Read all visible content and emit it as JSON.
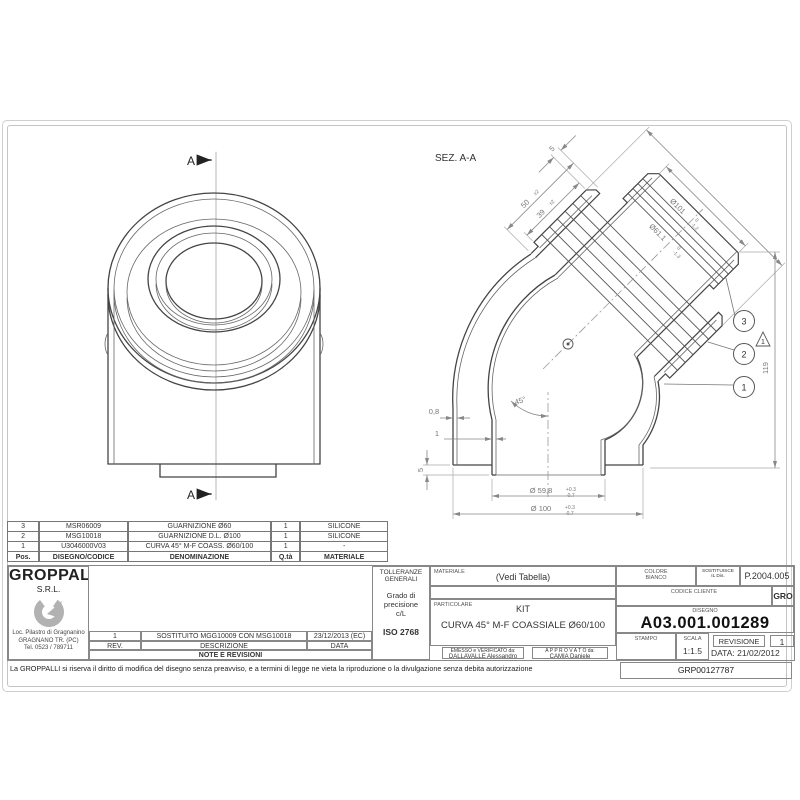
{
  "views": {
    "front": {
      "section_label_top": "A",
      "section_label_bottom": "A"
    },
    "section": {
      "title": "SEZ. A-A",
      "dims": {
        "len50": {
          "v": "50",
          "tol": "±2"
        },
        "len39": {
          "v": "39",
          "tol": "±2"
        },
        "len5_top": "5",
        "dia101": {
          "v": "Ø101",
          "tol_hi": "0",
          "tol_lo": "-1.2"
        },
        "dia61": {
          "v": "Ø61.1",
          "tol_hi": "0",
          "tol_lo": "-1.3"
        },
        "height119": "119",
        "angle": "45°",
        "wall08": "0,8",
        "wall1": "1",
        "step5": "5",
        "dia598": {
          "v": "Ø 59,8",
          "tol_hi": "+0.3",
          "tol_lo": "-0.7"
        },
        "dia100": {
          "v": "Ø 100",
          "tol_hi": "+0.3",
          "tol_lo": "-0.7"
        }
      },
      "balloons": {
        "b1": "1",
        "b2": "2",
        "b3": "3"
      },
      "rev_flag": "1"
    }
  },
  "parts_table": {
    "headers": [
      "Pos.",
      "DISEGNO/CODICE",
      "DENOMINAZIONE",
      "Q.tà",
      "MATERIALE"
    ],
    "rows": [
      {
        "pos": "3",
        "code": "MSR06009",
        "name": "GUARNIZIONE Ø60",
        "qty": "1",
        "material": "SILICONE"
      },
      {
        "pos": "2",
        "code": "MSG10018",
        "name": "GUARNIZIONE D.L. Ø100",
        "qty": "1",
        "material": "SILICONE"
      },
      {
        "pos": "1",
        "code": "U3046000V03",
        "name": "CURVA 45° M-F COASS. Ø60/100",
        "qty": "1",
        "material": "-"
      }
    ]
  },
  "company": {
    "name": "GROPPALLI",
    "suffix": "S.R.L.",
    "address1": "Loc. Pilastro di Gragnanino",
    "address2": "GRAGNANO TR. (PC)",
    "phone": "Tel. 0523 / 789711"
  },
  "revisions": {
    "rev": "1",
    "description": "SOSTITUITO MGG10009 CON MSG10018",
    "date": "23/12/2013 (EC)",
    "col_rev": "REV.",
    "col_desc": "DESCRIZIONE",
    "col_date": "DATA",
    "footer": "NOTE E REVISIONI"
  },
  "tolerances": {
    "title1": "TOLLERANZE",
    "title2": "GENERALI",
    "grade1": "Grado di",
    "grade2": "precisione",
    "grade3": "c/L",
    "standard": "ISO 2768"
  },
  "part_info": {
    "material_label": "MATERIALE",
    "material_value": "(Vedi Tabella)",
    "particolare_label": "PARTICOLARE",
    "kit": "KIT",
    "description": "CURVA 45° M-F COASSIALE Ø60/100",
    "issued_label": "EMESSO e VERIFICATO da:",
    "issued_by": "DALLAVALLE Alessandro",
    "approved_label": "A P P R O V A T O da:",
    "approved_by": "CAMIA Daniele"
  },
  "title_block": {
    "color_label": "COLORE",
    "color_value": "BIANCO",
    "replaces_label": "SOSTITUISCE",
    "replaces_label2": "IL Dis.",
    "replaces_value": "P.2004.005",
    "client_code_label": "CODICE CLIENTE",
    "client_code_value": "GRO",
    "drawing_label": "DISEGNO",
    "drawing_number": "A03.001.001289",
    "stamp_label": "STAMPO",
    "scale_label": "SCALA",
    "scale_value": "1:1.5",
    "revision_label": "REVISIONE",
    "revision_value": "1",
    "date_label": "DATA:",
    "date_value": "21/02/2012"
  },
  "footer": {
    "disclaimer": "La GROPPALLI si riserva il diritto di modifica del disegno senza preavviso, e a termini di legge ne vieta la riproduzione o la divulgazione senza debita autorizzazione",
    "code": "GRP00127787"
  }
}
